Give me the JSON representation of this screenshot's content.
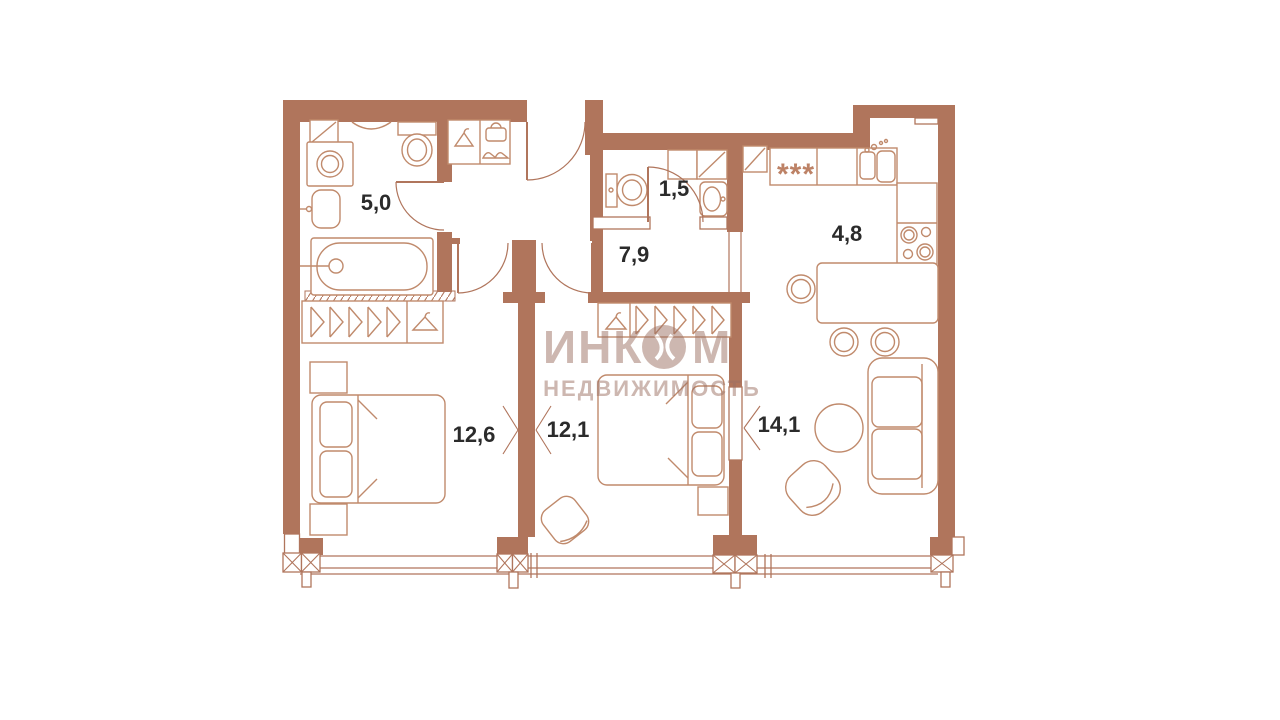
{
  "watermark": {
    "brand_prefix": "ИНК",
    "brand_suffix": "М",
    "brand_full": "ИНКОМ",
    "tagline": "НЕДВИЖИМОСТЬ"
  },
  "room_labels": {
    "bathroom": "5,0",
    "wc": "1,5",
    "hallway": "7,9",
    "kitchen": "4,8",
    "bedroom_1": "12,6",
    "bedroom_2": "12,1",
    "living_room": "14,1"
  },
  "symbols": {
    "hob": "***"
  },
  "colors": {
    "wall": "#b0755c",
    "fixture_line": "#c08a6c",
    "label_text": "#2b2b2b",
    "watermark": "#9c7164",
    "background": "#ffffff"
  },
  "fixtures": [
    "bathtub",
    "washing-machine",
    "toilet",
    "wash-basin",
    "entry-closet",
    "wardrobe-hangers",
    "double-bed",
    "nightstand",
    "pouf",
    "kitchen-counter",
    "cooktop",
    "kitchen-sink",
    "dining-table",
    "chair",
    "coffee-table",
    "sofa",
    "armchair",
    "window-band",
    "pier-column",
    "door-swing"
  ]
}
